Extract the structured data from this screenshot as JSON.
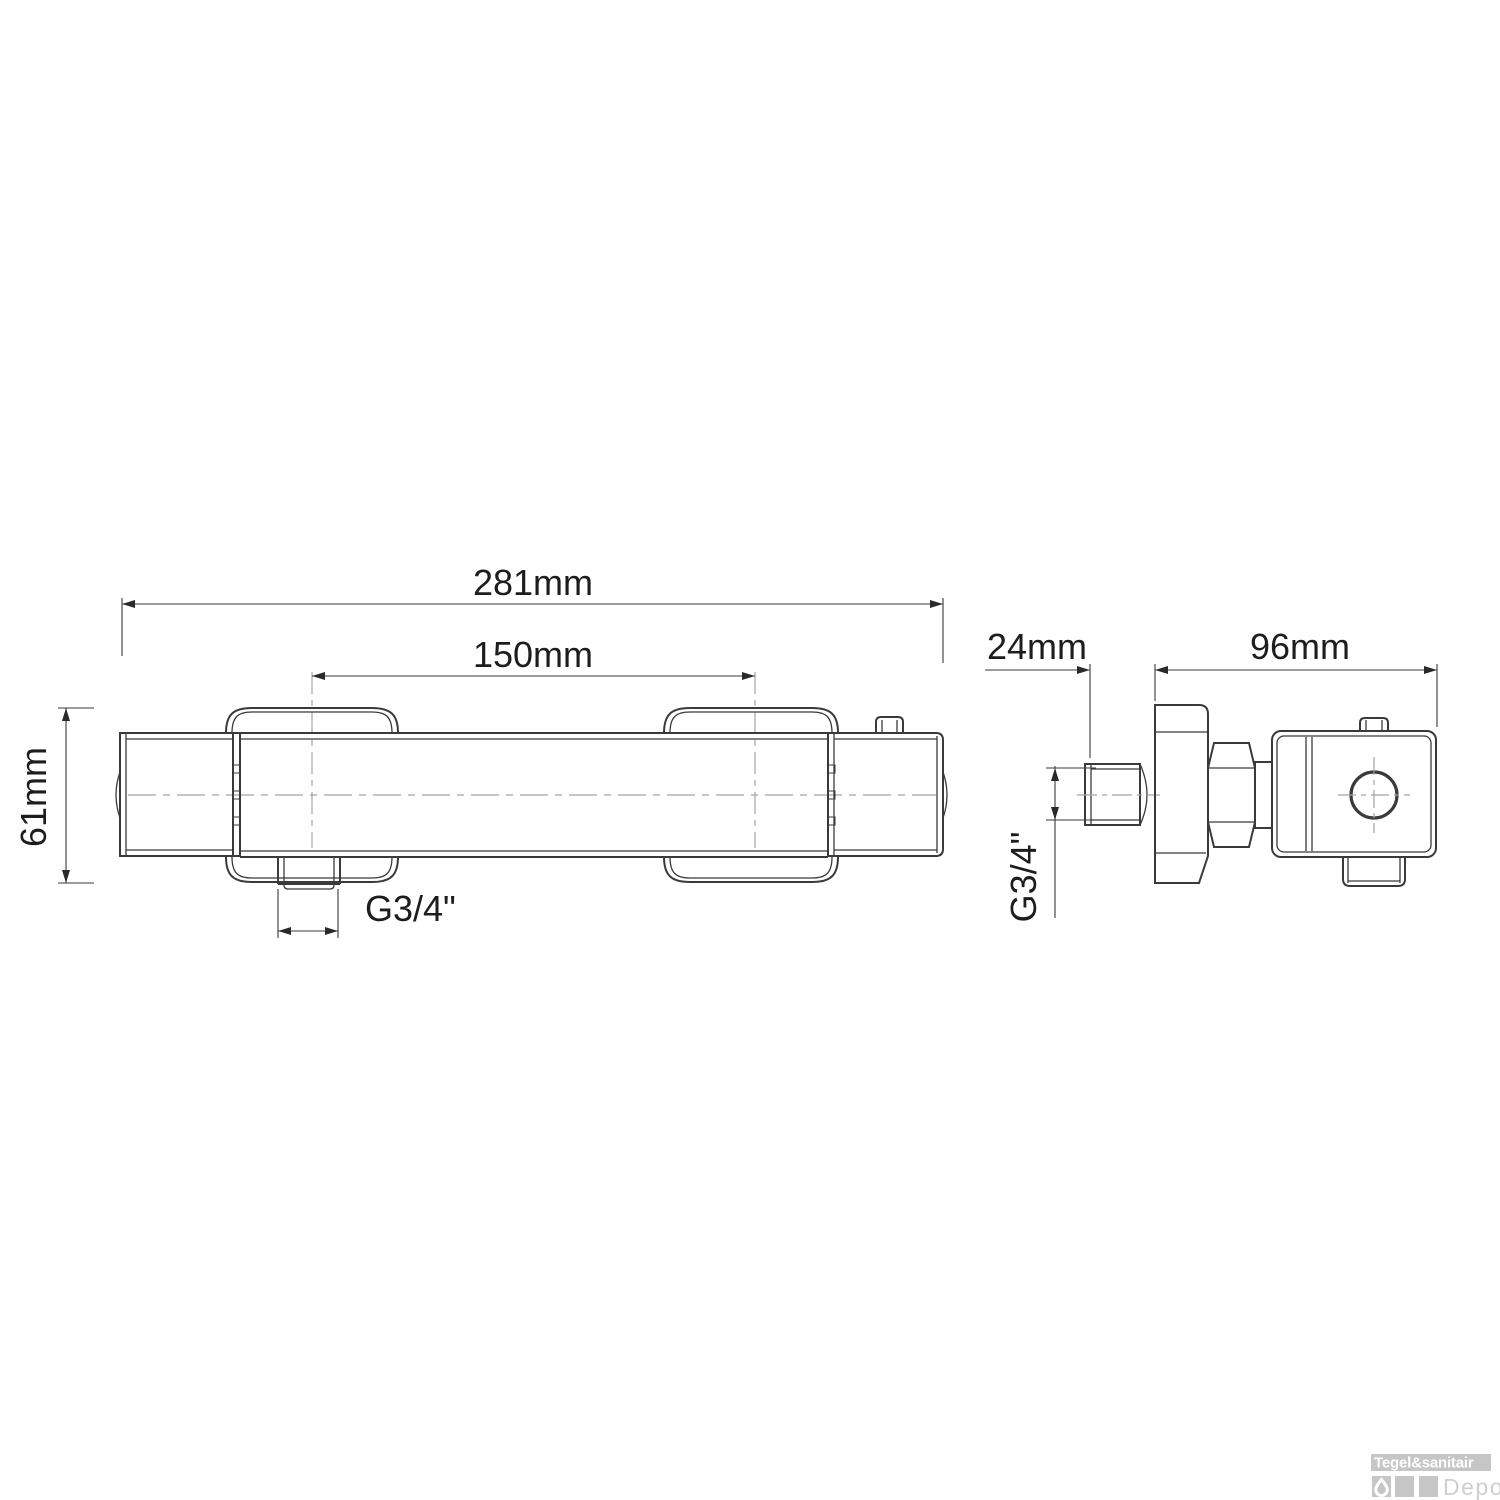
{
  "drawing": {
    "type": "technical-dimension-drawing",
    "subject": "thermostatic shower mixer tap, front view and side view",
    "dimensions": {
      "overall_width": "281mm",
      "hole_centers": "150mm",
      "body_height": "61mm",
      "outlet_thread": "G3/4\"",
      "inlet_depth": "24mm",
      "side_depth": "96mm",
      "inlet_thread": "G3/4\""
    }
  },
  "watermark": {
    "brand": "Tegel&sanitair",
    "sub_brand": "Depot"
  },
  "colors": {
    "background": "#ffffff",
    "line": "#3a3a3a",
    "thin_line": "#4a4a4a",
    "centerline": "#a3a3a3",
    "dimension_text": "#1d1d1d",
    "watermark_gray": "#c6c6c6",
    "watermark_brand_text": "#ffffff",
    "watermark_sub_text": "#cfcfcf"
  }
}
